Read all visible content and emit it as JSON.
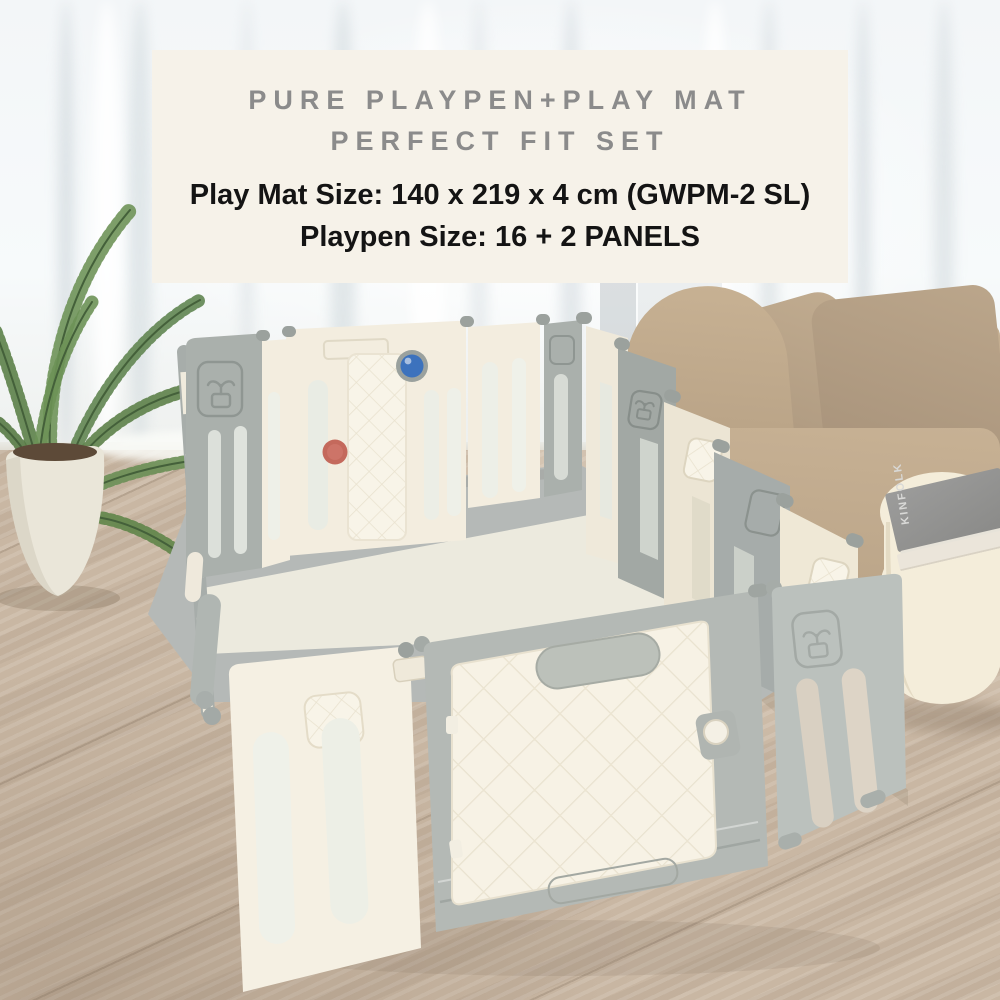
{
  "banner": {
    "title_line1": "PURE PLAYPEN+PLAY MAT",
    "title_line2": "PERFECT FIT SET",
    "spec_line1": "Play Mat Size: 140 x 219 x 4 cm (GWPM-2 SL)",
    "spec_line2": "Playpen Size: 16 + 2 PANELS"
  },
  "decor": {
    "book_title": "KINFOLK"
  },
  "colors": {
    "banner-bg": "#f6f2e9",
    "banner-title": "#8b8b8b",
    "banner-text": "#141414",
    "panel-gray": "#aab0ac",
    "panel-gray-light": "#bbc1bd",
    "panel-cream": "#f3eddf",
    "door-cream": "#f7f2e5",
    "frame-gray": "#b4b9b5",
    "mat-gray": "#b5b9b7",
    "mat-cream": "#eceade",
    "ball-blue": "#3c72bd",
    "knob-red": "#c4695c",
    "sofa-beige": "#bda78a",
    "pillow-beige": "#b29d83",
    "table-cream": "#f4edda",
    "floor-wood": "#c9b7a3",
    "leaf-green": "#5d8149",
    "curtain-white": "#f6f9fa"
  }
}
